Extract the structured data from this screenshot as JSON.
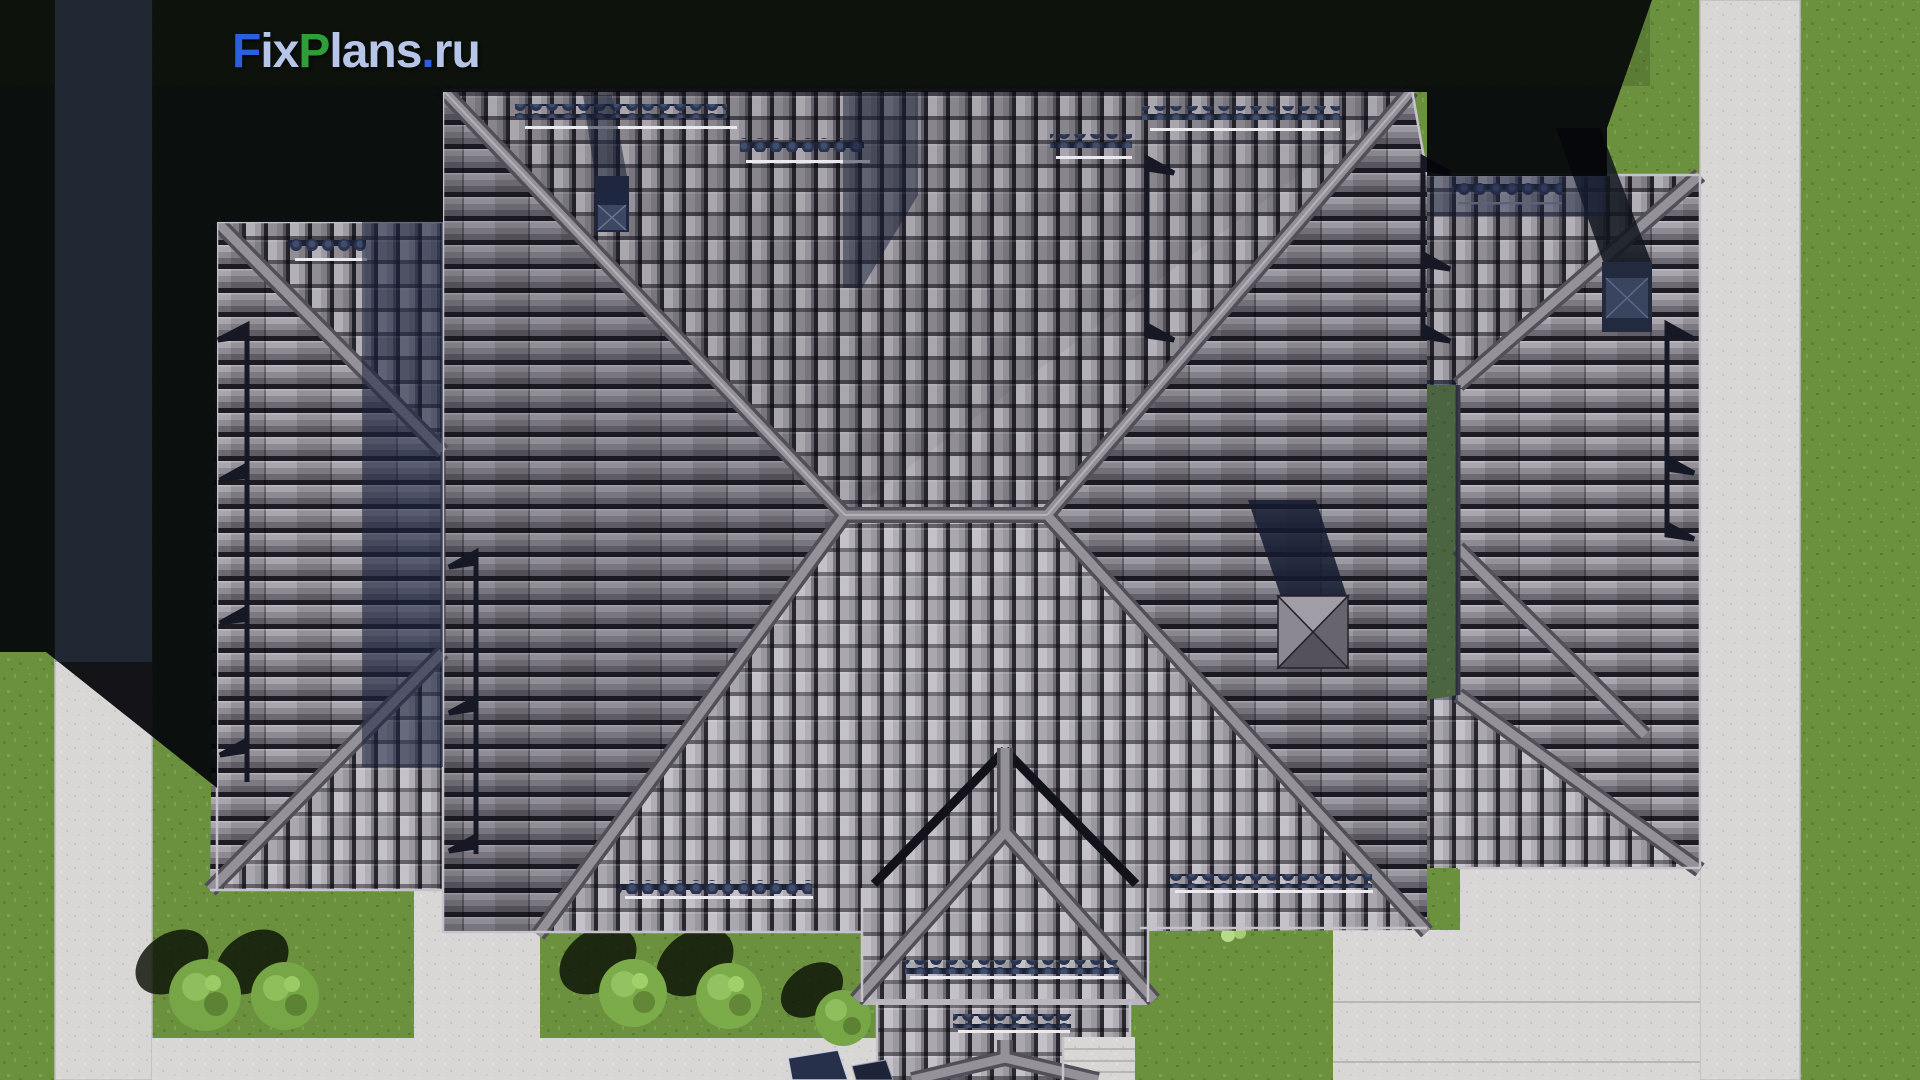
{
  "watermark": {
    "text": "FixPlans.ru",
    "segments": [
      {
        "t": "F",
        "color": "#2b5fdd"
      },
      {
        "t": "ix",
        "color": "#b7c5e9"
      },
      {
        "t": "P",
        "color": "#2f9e38"
      },
      {
        "t": "lans",
        "color": "#b7c5e9"
      },
      {
        "t": ".",
        "color": "#2b5fdd"
      },
      {
        "t": "ru",
        "color": "#b7c5e9"
      }
    ]
  },
  "scene": {
    "type": "aerial top-down 3D render of a single-family house",
    "roof_material": "gray interlocking roof tiles",
    "roof_sections": [
      "left-wing-hip-roof",
      "central-hip-roof",
      "right-wing-hip-roof",
      "two-tier-entrance-porch-roof"
    ],
    "roof_features": {
      "ridge_junctions": 2,
      "snow_guard_rows": 10,
      "drain_pipes": 5,
      "chimney_vents": 3
    },
    "lighting": "sun from lower-right, hard black shadow cast to upper-left",
    "landscape": {
      "lawns": "green grass around house",
      "paths": [
        "left concrete walkway",
        "right concrete walkway",
        "bottom terrace and pavement",
        "porch steps"
      ],
      "bushes": 5,
      "car_fragment_bottom": true
    }
  },
  "palette": {
    "tile_light": "#b3b0b7",
    "tile_mid": "#8f8c95",
    "tile_dark": "#67646e",
    "ridge_bar": "#949199",
    "valley": "#12121a",
    "grass": "#6b913e",
    "grass_shadowed": "#1c2b14",
    "pavement": "#d9d7d5",
    "cast_shadow": "#04050a",
    "soft_shadow_blue": "#1a2340",
    "chimney_navy": "#222a40",
    "scallop_navy": "#2a3450"
  }
}
